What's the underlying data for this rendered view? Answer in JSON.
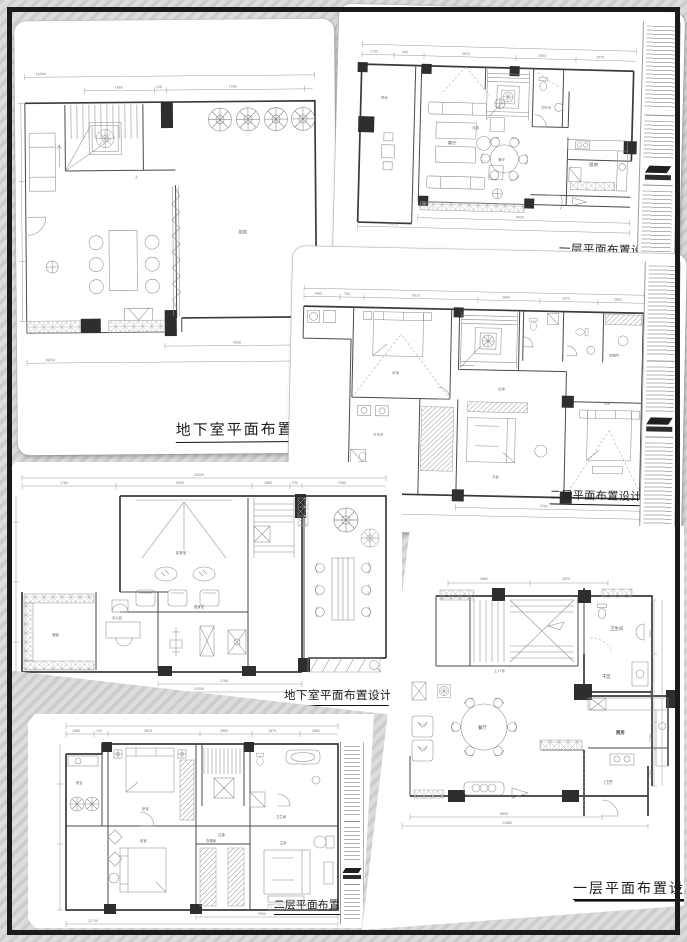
{
  "canvas": {
    "frame_color": "#1a1a1a"
  },
  "sheets": {
    "a": {
      "title": "地下室平面布置图",
      "labels": {
        "garden": "花园",
        "up": "上"
      },
      "dims": {
        "top_total": "16500",
        "seg1": "1860",
        "seg2": "330",
        "seg3": "1590",
        "bottom_seg": "5050",
        "bottom_total": "16650"
      }
    },
    "b": {
      "title": "一层平面布置设计图",
      "labels": {
        "balcony": "阳台",
        "living": "客厅",
        "dining": "餐厅",
        "kitchen": "厨房",
        "bath": "卫生间",
        "hall": "过道"
      },
      "dims": {
        "seg1": "1735",
        "seg2": "945",
        "seg3": "5615",
        "seg4": "2665",
        "seg5": "1875",
        "bottom1": "8930",
        "bottom_total": "13135"
      }
    },
    "c": {
      "title": "二层平面布置设计图",
      "labels": {
        "master": "主卧",
        "bed2": "次卧",
        "bed3": "卧室",
        "cloak": "衣帽间",
        "bath": "卫生间",
        "hall": "过道"
      },
      "dims": {
        "seg1": "1465",
        "seg2": "745",
        "seg3": "5615",
        "seg4": "2665",
        "seg5": "1875",
        "seg6": "2665",
        "bottom1": "2590",
        "bottom_total": "12730"
      }
    },
    "d": {
      "title": "地下室平面布置设计图",
      "labels": {
        "av": "影音室",
        "gym": "健身区",
        "cellar": "酒窖",
        "office": "办公区"
      },
      "dims": {
        "top_total": "24300",
        "seg1": "1780",
        "seg2": "5950",
        "seg3": "1860",
        "seg4": "330",
        "seg5": "5380",
        "bottom1": "1780",
        "bottom_total": "24300"
      }
    },
    "e": {
      "title": "二层平面布置设计图",
      "labels": {
        "balcony": "阳台",
        "bed1": "卧室",
        "bed2": "卧室",
        "master": "主卧",
        "cloak": "衣帽间",
        "bath": "卫生间",
        "hall": "过道"
      },
      "dims": {
        "seg1": "1465",
        "seg2": "745",
        "seg3": "5615",
        "seg4": "2665",
        "seg5": "1875",
        "seg6": "2665",
        "bottom1": "5950",
        "bottom_total": "12730"
      }
    },
    "f": {
      "title": "一层平面布置设计图",
      "labels": {
        "dining": "餐厅",
        "kitchen": "厨房",
        "bath": "卫生间",
        "dry": "干区",
        "foyer": "门厅",
        "stairs_note": "上17步"
      },
      "dims": {
        "top1": "2685",
        "top2": "1875",
        "right1": "2985",
        "right2": "6665",
        "right3": "2190",
        "right4": "1285",
        "bottom1": "9600",
        "bottom_total": "11680"
      }
    }
  }
}
